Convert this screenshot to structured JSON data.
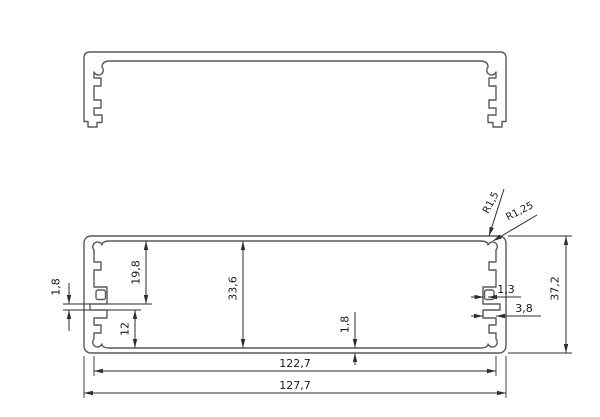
{
  "drawing": {
    "type": "technical-cross-section",
    "views": {
      "top_view": "lid channel profile",
      "front_view": "enclosure body profile"
    },
    "dimensions": {
      "d_19_8": "19,8",
      "d_12": "12",
      "d_33_6": "33,6",
      "d_1_8_left": "1,8",
      "d_1_8_bottom": "1,8",
      "d_37_2": "37,2",
      "d_1_3": "1,3",
      "d_3_8": "3,8",
      "d_122_7": "122,7",
      "d_127_7": "127,7"
    },
    "radii": {
      "r_1_5": "R1,5",
      "r_1_25": "R1,25"
    },
    "colors": {
      "line": "#5a5a5a",
      "dim": "#2e2e2e",
      "text": "#1a1a1a",
      "background": "#ffffff"
    }
  }
}
